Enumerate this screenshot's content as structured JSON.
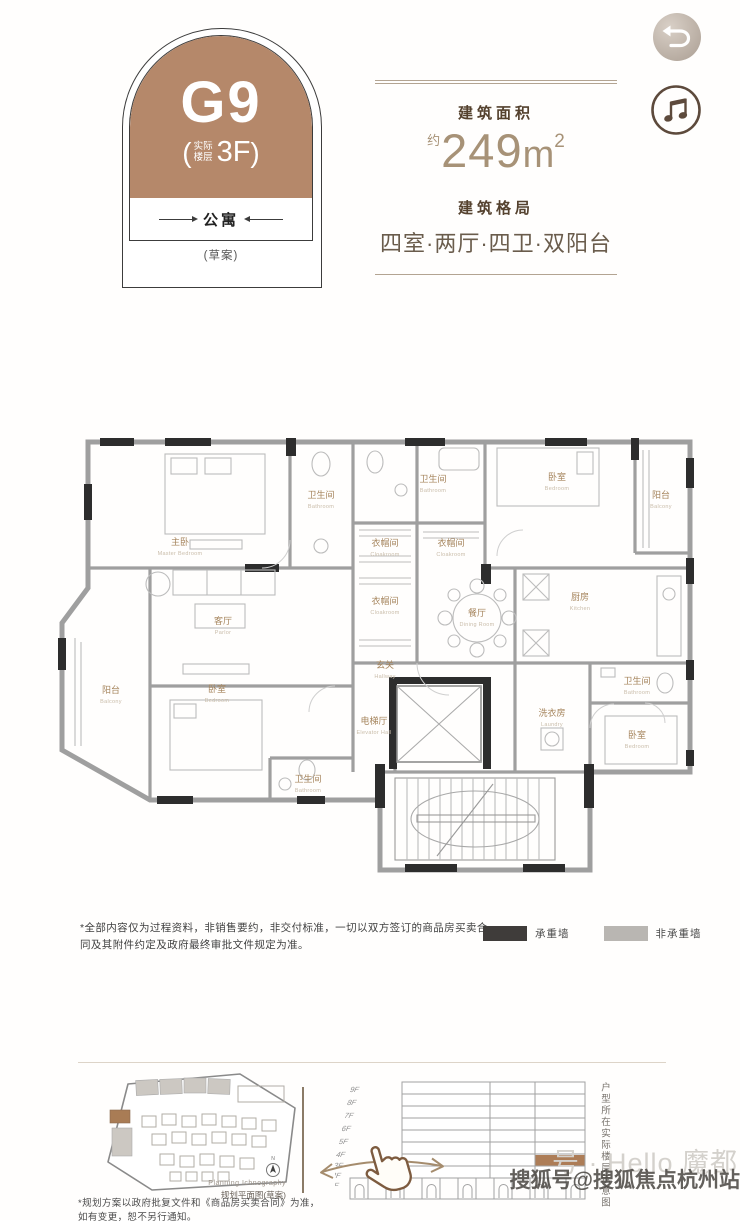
{
  "header": {
    "badge": {
      "unit": "G9",
      "paren_open": "(",
      "floor_note_top": "实际",
      "floor_note_bottom": "楼层",
      "floor": "3F",
      "paren_close": ")",
      "category": "公寓",
      "draft": "(草案)"
    },
    "area": {
      "label": "建筑面积",
      "approx": "约",
      "value": "249",
      "unit": "m",
      "sup": "2"
    },
    "layout": {
      "label": "建筑格局",
      "value": "四室·两厅·四卫·双阳台"
    }
  },
  "icons": {
    "back": "undo-return-arrow",
    "music": "music-note",
    "compass": "north-compass",
    "hand": "swipe-hand-pointer"
  },
  "colors": {
    "brand_brown": "#b5886a",
    "line_taupe": "#b3a492",
    "highlight_floor": "#ad7d57",
    "bearing_wall": "#3f3c3a",
    "non_bearing_wall": "#b9b6b2"
  },
  "floor_plan": {
    "rooms": [
      {
        "cn": "主卧",
        "en": "Master Bedroom"
      },
      {
        "cn": "卫生间",
        "en": "Bathroom"
      },
      {
        "cn": "卫生间",
        "en": "Bathroom"
      },
      {
        "cn": "衣帽间",
        "en": "Cloakroom"
      },
      {
        "cn": "衣帽间",
        "en": "Cloakroom"
      },
      {
        "cn": "卧室",
        "en": "Bedroom"
      },
      {
        "cn": "阳台",
        "en": "Balcony"
      },
      {
        "cn": "客厅",
        "en": "Parlor"
      },
      {
        "cn": "衣帽间",
        "en": "Cloakroom"
      },
      {
        "cn": "餐厅",
        "en": "Dining Room"
      },
      {
        "cn": "厨房",
        "en": "Kitchen"
      },
      {
        "cn": "玄关",
        "en": "Hallway"
      },
      {
        "cn": "阳台",
        "en": "Balcony"
      },
      {
        "cn": "卧室",
        "en": "Bedroom"
      },
      {
        "cn": "卫生间",
        "en": "Bathroom"
      },
      {
        "cn": "电梯厅",
        "en": "Elevator Hall"
      },
      {
        "cn": "洗衣房",
        "en": "Laundry"
      },
      {
        "cn": "卫生间",
        "en": "Bathroom"
      },
      {
        "cn": "卧室",
        "en": "Bedroom"
      }
    ],
    "legend": {
      "bearing_label": "承重墙",
      "non_bearing_label": "非承重墙"
    },
    "disclaimer": "*全部内容仅为过程资料，非销售要约，非交付标准，一切以双方签订的商品房买卖合同及其附件约定及政府最终审批文件规定为准。"
  },
  "site_plan": {
    "caption_en": "Planning Ichnography",
    "caption_cn": "规划平面图(草案)",
    "compass": "N",
    "note_line1": "*规划方案以政府批复文件和《商品房买卖合同》为准，",
    "note_line2": "如有变更，恕不另行通知。"
  },
  "elevation": {
    "floors": [
      "9F",
      "8F",
      "7F",
      "6F",
      "5F",
      "4F",
      "3F",
      "2F",
      "1F"
    ],
    "highlight_floor": "3F",
    "side_label": "户型所在实际楼层示意图"
  },
  "watermarks": {
    "light": "号 · Hello 魔都",
    "dark": "搜狐号@搜狐焦点杭州站"
  }
}
